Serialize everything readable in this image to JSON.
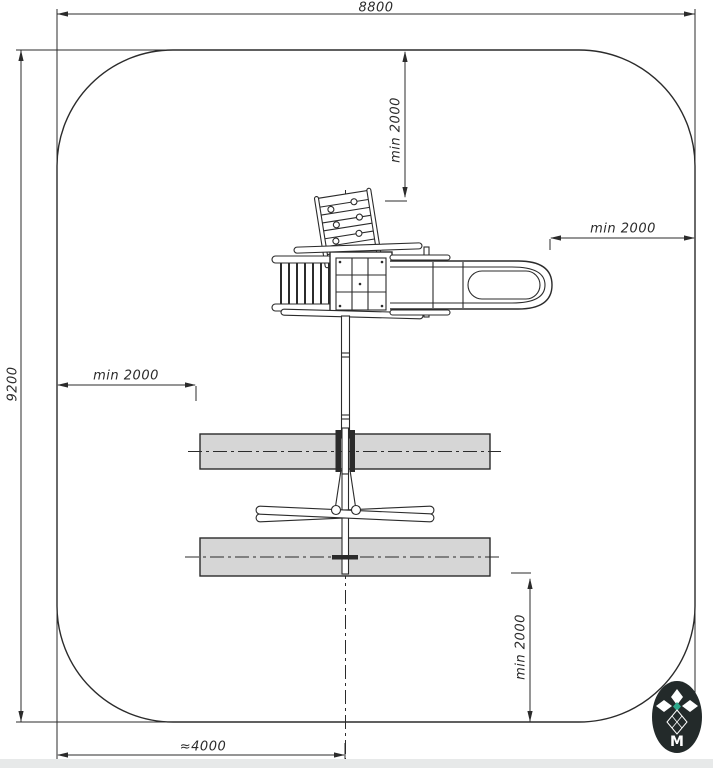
{
  "page": {
    "background": "#ffffff",
    "bottom_band_color": "#e7e9e9"
  },
  "drawing": {
    "type": "playground-safety-zone-plan-top-view",
    "line_color": "#2b2b2b",
    "safety_zone_fill": "#d6d6d6",
    "dimensions": {
      "top_width": "8800",
      "left_height": "9200",
      "clearance_top": "min 2000",
      "clearance_right": "min 2000",
      "clearance_left": "min 2000",
      "clearance_bottom_right": "min 2000",
      "bottom_width": "≈4000"
    },
    "components": [
      "climbing-ramp",
      "ladder",
      "platform",
      "slide",
      "swing-beam-pole",
      "a-frame-legs",
      "swing-safety-zone-upper",
      "swing-safety-zone-lower"
    ]
  },
  "logo": {
    "monogram": "M",
    "background": "#232a2a",
    "accent": "#2fa98c"
  }
}
